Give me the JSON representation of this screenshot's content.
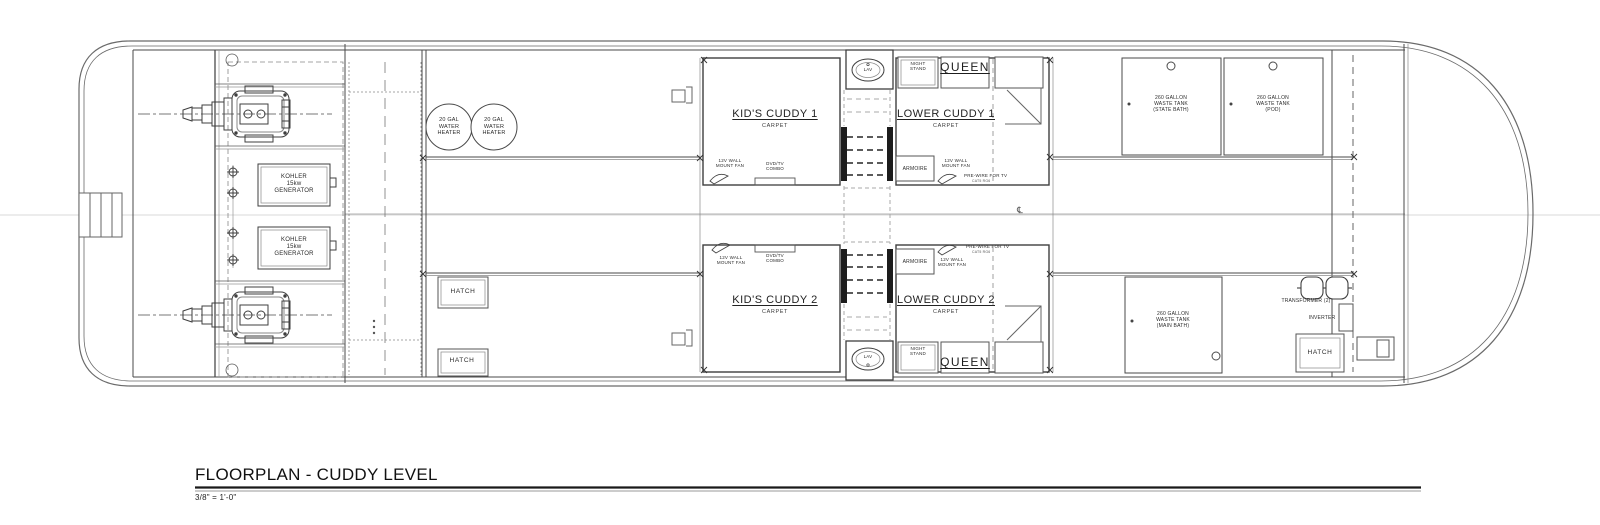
{
  "sheet": {
    "title": "FLOORPLAN - CUDDY LEVEL",
    "scale": "3/8\" = 1'-0\""
  },
  "rooms": {
    "kids_cuddy_1": {
      "name": "KID'S CUDDY 1",
      "floor": "CARPET"
    },
    "kids_cuddy_2": {
      "name": "KID'S CUDDY 2",
      "floor": "CARPET"
    },
    "lower_cuddy_1": {
      "name": "LOWER CUDDY 1",
      "floor": "CARPET"
    },
    "lower_cuddy_2": {
      "name": "LOWER CUDDY 2",
      "floor": "CARPET"
    }
  },
  "fixtures": {
    "lav": "LAV",
    "night_stand": "NIGHT\nSTAND",
    "queen": "QUEEN",
    "armoire": "ARMOIRE",
    "hatch": "HATCH",
    "fan": "12V WALL\nMOUNT FAN",
    "dvd_tv": "DVD/TV\nCOMBO",
    "prewire_tv": "PRE-WIRE FOR TV",
    "prewire_tv_sub": "CAT5 RG6"
  },
  "equipment": {
    "generator": "KOHLER\n15kw\nGENERATOR",
    "water_heater": "20 GAL\nWATER\nHEATER",
    "waste_tank_state_bath": "260 GALLON\nWASTE TANK\n(STATE BATH)",
    "waste_tank_pod": "260 GALLON\nWASTE TANK\n(POD)",
    "waste_tank_main_bath": "260 GALLON\nWASTE TANK\n(MAIN BATH)",
    "transformer": "TRANSFORMER (2)",
    "inverter": "INVERTER"
  },
  "symbols": {
    "centerline": "℄"
  },
  "colors": {
    "line": "#4a4a4a",
    "line_light": "#999999",
    "text": "#2b2b2b",
    "background": "#ffffff"
  }
}
